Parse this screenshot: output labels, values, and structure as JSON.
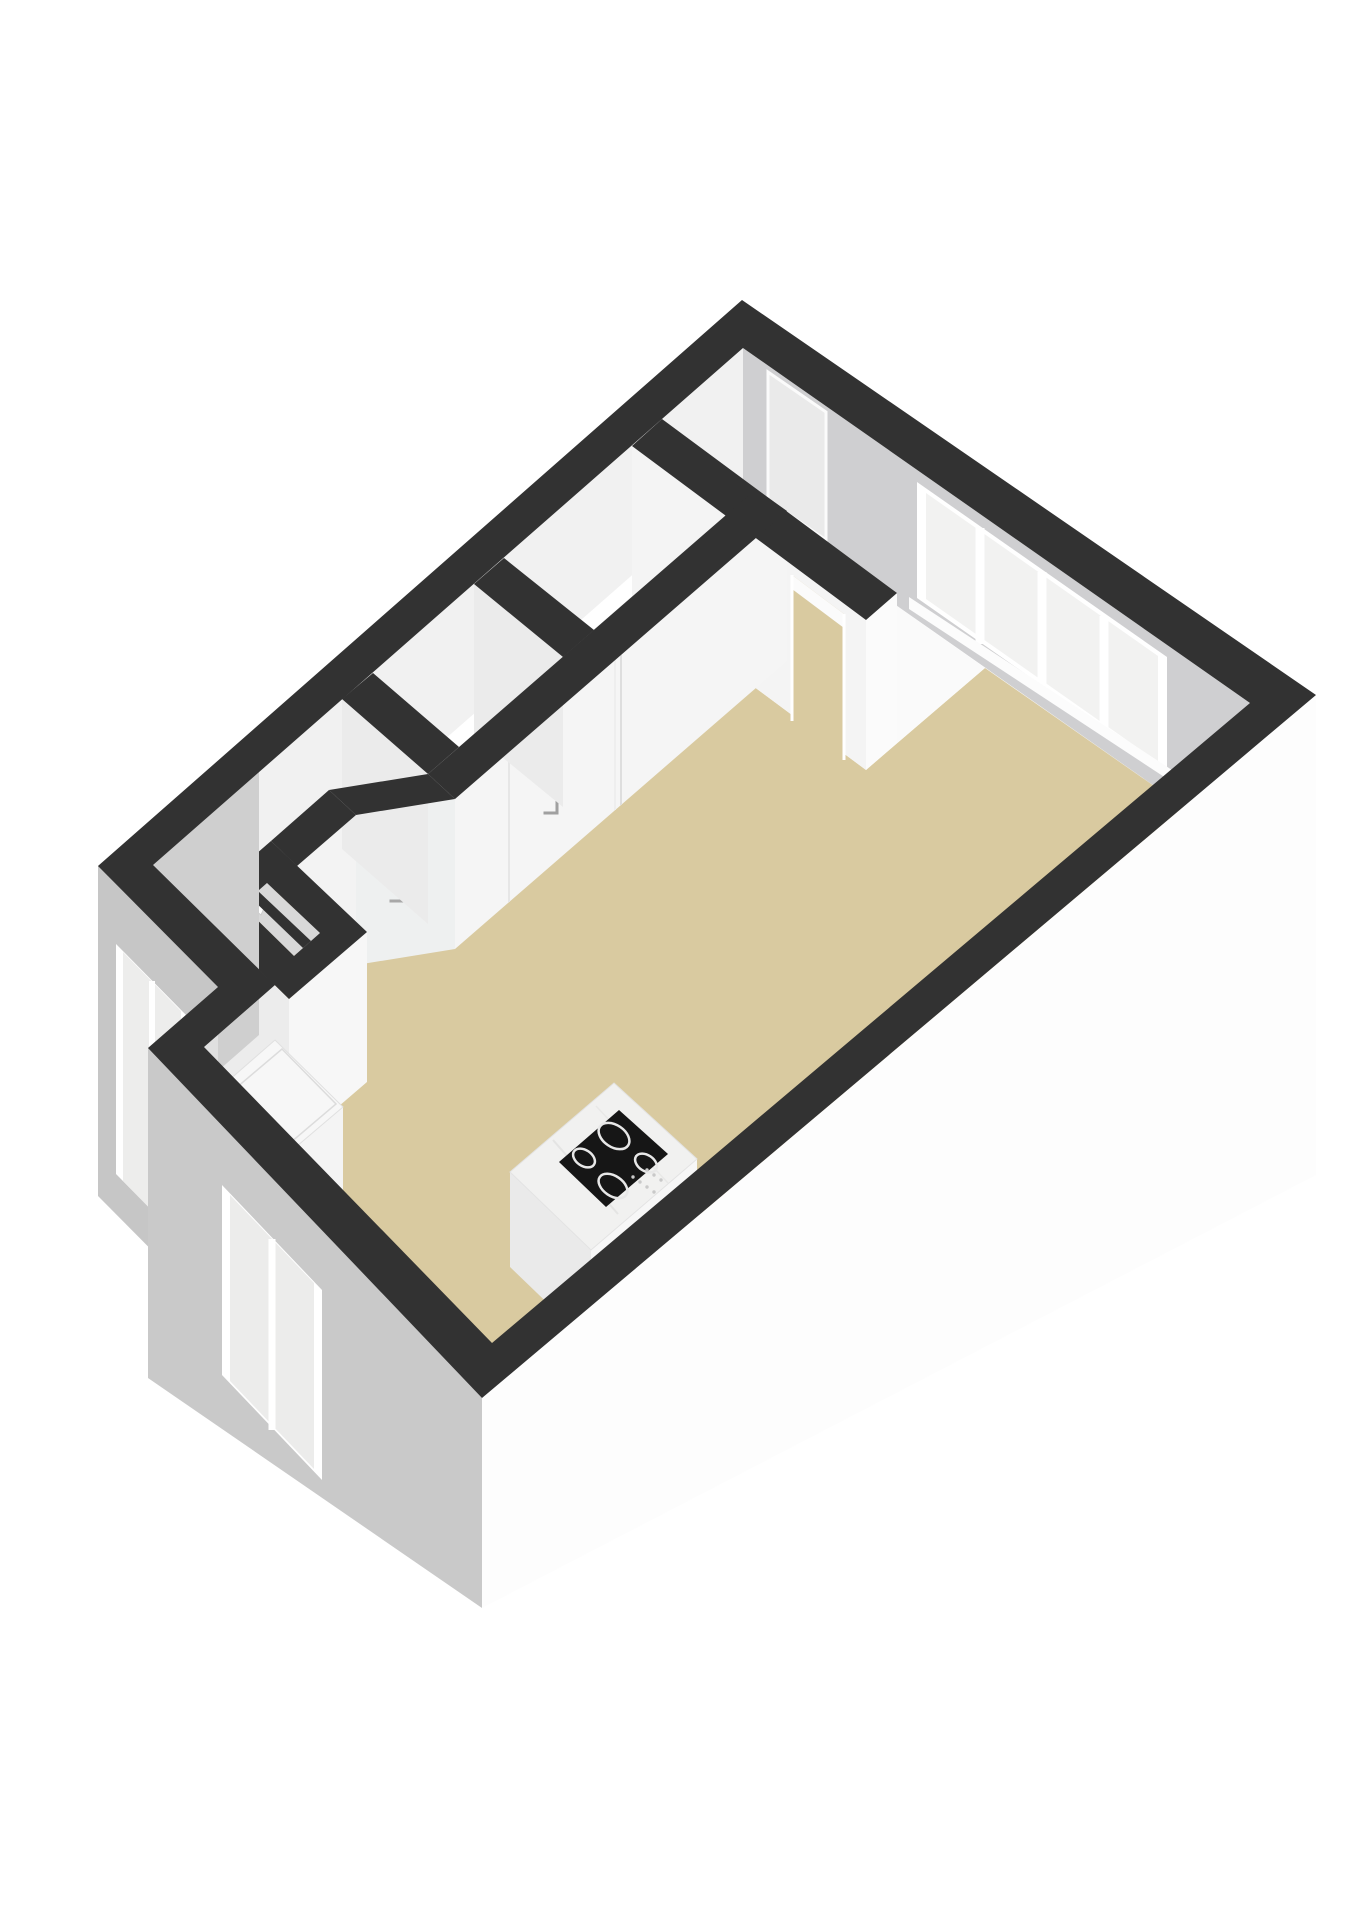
{
  "meta": {
    "view": "floorplan-3d-overview"
  },
  "colors": {
    "background": "#ffffff",
    "wall_cap_dark": "#323232",
    "floor_beige": "#d9caa0",
    "floor_white": "#fafafa",
    "wall_interior_gray": "#cfcfd1",
    "wall_interior_white": "#f1f1f1",
    "exterior_white": "#fdfdfd",
    "exterior_gray": "#c9c9c9",
    "window_frame": "#ffffff",
    "glass": "#f2f2f1",
    "marble": "#f1f1f0",
    "cooktop_black": "#161616"
  },
  "scene": {
    "width": 1358,
    "height": 1920,
    "layers": [
      {
        "name": "floors",
        "shapes": [
          {
            "kind": "poly",
            "name": "main-room-floor",
            "points": "985,668 1250,853 492,1351 204,1055 275,993 153,873 314,874 398,950 726,666 866,770",
            "fill": "#d9caa0"
          },
          {
            "kind": "poly",
            "name": "hall-floor",
            "points": "743,498 985,668 897,743 662,569",
            "fill": "#fafafa"
          },
          {
            "kind": "poly",
            "name": "bathroom-floor",
            "points": "632,596 726,666 594,780 504,708",
            "fill": "#f7f7f7"
          },
          {
            "kind": "poly",
            "name": "toilet-floor",
            "points": "474,734 563,807 459,897 373,823",
            "fill": "#f7f7f7"
          }
        ]
      },
      {
        "name": "far-walls",
        "shapes": [
          {
            "kind": "poly",
            "name": "northeast-wall-face",
            "points": "743,348 1250,703 1250,853 743,498",
            "fill": "#cfcfd1"
          },
          {
            "kind": "poly",
            "name": "entrance-door",
            "points": "768,372 826,412 826,540 768,500",
            "fill": "#eaeaea",
            "stroke": "#fbfbfb",
            "sw": 3
          },
          {
            "kind": "poly",
            "name": "main-window-frame",
            "points": "917,482 1167,657 1167,773 917,598",
            "fill": "#ffffff"
          },
          {
            "kind": "poly",
            "name": "main-window-glass",
            "points": "926,493 1158,656 1158,762 926,599",
            "fill": "#f2f2f1"
          },
          {
            "kind": "line",
            "name": "main-window-mullion-1",
            "x1": 980,
            "y1": 528,
            "x2": 980,
            "y2": 644,
            "stroke": "#ffffff",
            "sw": 9
          },
          {
            "kind": "line",
            "name": "main-window-mullion-2",
            "x1": 1042,
            "y1": 572,
            "x2": 1042,
            "y2": 688,
            "stroke": "#ffffff",
            "sw": 9
          },
          {
            "kind": "line",
            "name": "main-window-mullion-3",
            "x1": 1104,
            "y1": 616,
            "x2": 1104,
            "y2": 732,
            "stroke": "#ffffff",
            "sw": 9
          },
          {
            "kind": "poly",
            "name": "main-window-sill",
            "points": "909,597 1175,772 1175,784 909,609",
            "fill": "#fcfcfc"
          },
          {
            "kind": "poly",
            "name": "northwest-wall-face",
            "points": "743,348 153,865 153,995 743,478",
            "fill": "#f1f1f1"
          }
        ]
      },
      {
        "name": "partitions",
        "shapes": [
          {
            "kind": "poly",
            "name": "hall-partition-face",
            "points": "632,446 866,620 866,770 632,596",
            "fill": "#f4f4f4"
          },
          {
            "kind": "poly",
            "name": "doorway-opening",
            "points": "792,575 844,614 844,760 792,721",
            "fill": "#d9caa0"
          },
          {
            "kind": "poly",
            "name": "doorway-top-sliver",
            "points": "792,575 844,614 844,628 792,589",
            "fill": "#fbfbfb"
          },
          {
            "kind": "line",
            "name": "doorway-jamb-left",
            "x1": 792,
            "y1": 575,
            "x2": 792,
            "y2": 721,
            "stroke": "#ffffff",
            "sw": 3
          },
          {
            "kind": "line",
            "name": "doorway-jamb-right",
            "x1": 844,
            "y1": 614,
            "x2": 844,
            "y2": 760,
            "stroke": "#ffffff",
            "sw": 3
          },
          {
            "kind": "poly",
            "name": "hall-partition-end-face",
            "points": "897,593 866,620 866,770 897,743",
            "fill": "#fbfbfb"
          },
          {
            "kind": "poly",
            "name": "closet-wall-face",
            "points": "787,511 455,799 455,949 787,661",
            "fill": "#f5f5f5"
          },
          {
            "kind": "line",
            "name": "closet-door-seam-1",
            "x1": 621,
            "y1": 655,
            "x2": 621,
            "y2": 805,
            "stroke": "#dedede",
            "sw": 2
          },
          {
            "kind": "line",
            "name": "closet-door-seam-2",
            "x1": 615,
            "y1": 660,
            "x2": 615,
            "y2": 810,
            "stroke": "#eeeeee",
            "sw": 2
          },
          {
            "kind": "line",
            "name": "closet-door-seam-3",
            "x1": 509,
            "y1": 752,
            "x2": 509,
            "y2": 902,
            "stroke": "#e6e6e6",
            "sw": 2
          },
          {
            "kind": "polyline",
            "name": "door-handle-1",
            "points": "557,795 557,813 545,813",
            "stroke": "#a0a0a0",
            "sw": 3
          },
          {
            "kind": "poly",
            "name": "angled-wall-face",
            "points": "455,799 356,815 356,965 455,949",
            "fill": "#eef0f0"
          },
          {
            "kind": "polyline",
            "name": "door-handle-2",
            "points": "402,884 402,901 391,901",
            "stroke": "#a8a8a8",
            "sw": 3
          },
          {
            "kind": "poly",
            "name": "lower-wall-face",
            "points": "356,815 297,866 297,1016 356,965",
            "fill": "#f3f3f3"
          },
          {
            "kind": "poly",
            "name": "partition-band-1",
            "points": "474,584 563,657 563,807 474,734",
            "fill": "#ebebeb"
          },
          {
            "kind": "poly",
            "name": "partition-band-2",
            "points": "342,699 428,774 428,924 342,849",
            "fill": "#ebebeb"
          },
          {
            "kind": "poly",
            "name": "step-wall-face",
            "points": "275,985 204,1047 204,1197 275,1135",
            "fill": "#f6f6f6"
          }
        ]
      },
      {
        "name": "shaft",
        "shapes": [
          {
            "kind": "poly",
            "name": "shaft-side-southwest",
            "points": "195,907 289,999 289,1149 195,1057",
            "fill": "#ececec"
          },
          {
            "kind": "poly",
            "name": "shaft-side-southeast",
            "points": "367,932 289,999 289,1149 367,1082",
            "fill": "#f7f7f7"
          },
          {
            "kind": "poly",
            "name": "shaft-interior",
            "points": "267,883 320,933 294,956 242,905",
            "fill": "#d8d8d8"
          },
          {
            "kind": "poly",
            "name": "meter-box",
            "points": "254,894 266,904 261,915 249,905",
            "fill": "#ffffff",
            "stroke": "#cccccc",
            "sw": 1
          },
          {
            "kind": "poly",
            "name": "shaft-divider-cap",
            "points": "258,891 311,941 303,948 251,898",
            "fill": "#323232"
          },
          {
            "kind": "path",
            "name": "shaft-wall-cap",
            "d": "M271,841 L367,932 L289,999 L195,907 Z M267,883 L320,933 L294,956 L242,905 Z",
            "fill": "#323232",
            "rule": "evenodd"
          }
        ]
      },
      {
        "name": "kitchen-cabinet",
        "shapes": [
          {
            "kind": "poly",
            "name": "cabinet-side-southwest",
            "points": "204,1102 270,1169 270,1264 204,1197",
            "fill": "#e8e8e8"
          },
          {
            "kind": "poly",
            "name": "cabinet-side-southeast",
            "points": "343,1107 270,1169 270,1264 343,1202",
            "fill": "#f4f4f4"
          },
          {
            "kind": "poly",
            "name": "cabinet-countertop",
            "points": "275,1040 343,1107 270,1169 204,1102",
            "fill": "#f7f7f7",
            "stroke": "#e0e0e0",
            "sw": 1
          },
          {
            "kind": "poly",
            "name": "cabinet-countertop-inset",
            "points": "282,1049 336,1104 270,1160 216,1105",
            "fill": "none",
            "stroke": "#dcdcdc",
            "sw": 1.5
          }
        ]
      },
      {
        "name": "kitchen-island",
        "shapes": [
          {
            "kind": "poly",
            "name": "island-side-southwest",
            "points": "510,1172 591,1250 591,1345 510,1267",
            "fill": "#eaeaea"
          },
          {
            "kind": "poly",
            "name": "island-side-southeast",
            "points": "697,1159 591,1250 591,1345 697,1254",
            "fill": "#f7f7f7"
          },
          {
            "kind": "poly",
            "name": "island-marble-top",
            "points": "614,1083 697,1159 591,1250 510,1172",
            "fill": "#f1f1f0",
            "stroke": "#e3e3e3",
            "sw": 1
          },
          {
            "kind": "line",
            "name": "marble-vein-1",
            "x1": 553,
            "y1": 1140,
            "x2": 618,
            "y2": 1214,
            "stroke": "#e4e4e3",
            "sw": 2
          },
          {
            "kind": "line",
            "name": "marble-vein-2",
            "x1": 596,
            "y1": 1106,
            "x2": 668,
            "y2": 1183,
            "stroke": "#e8e8e7",
            "sw": 1.5
          },
          {
            "kind": "poly",
            "name": "cooktop",
            "points": "619,1110 668,1154 606,1207 559,1162",
            "fill": "#161616"
          },
          {
            "kind": "ellipse",
            "name": "cooktop-burner-1",
            "cx": 614,
            "cy": 1136,
            "rx": 17,
            "ry": 11,
            "rot": 34,
            "fill": "none",
            "stroke": "#e8e8e8",
            "sw": 2.5
          },
          {
            "kind": "ellipse",
            "name": "cooktop-burner-2",
            "cx": 646,
            "cy": 1163,
            "rx": 12,
            "ry": 8,
            "rot": 34,
            "fill": "none",
            "stroke": "#e8e8e8",
            "sw": 2.5
          },
          {
            "kind": "ellipse",
            "name": "cooktop-burner-3",
            "cx": 584,
            "cy": 1158,
            "rx": 12,
            "ry": 8,
            "rot": 34,
            "fill": "none",
            "stroke": "#e8e8e8",
            "sw": 2.5
          },
          {
            "kind": "ellipse",
            "name": "cooktop-burner-4",
            "cx": 613,
            "cy": 1186,
            "rx": 16,
            "ry": 10,
            "rot": 34,
            "fill": "none",
            "stroke": "#e8e8e8",
            "sw": 2.5
          },
          {
            "kind": "dots",
            "name": "cooktop-controls",
            "r": 1.7,
            "fill": "#c9c9c9",
            "centers": [
              [
                633,
                1177
              ],
              [
                640,
                1182
              ],
              [
                647,
                1187
              ],
              [
                654,
                1192
              ],
              [
                647,
                1170
              ],
              [
                654,
                1175
              ],
              [
                661,
                1180
              ]
            ]
          }
        ]
      },
      {
        "name": "exterior",
        "shapes": [
          {
            "kind": "poly",
            "name": "northwest-exterior-sliver",
            "points": "259,725 98,866 98,1176 259,1035",
            "fill": "#cfcfcf"
          },
          {
            "kind": "poly",
            "name": "northwest-exterior-window-hint",
            "points": "135,835 108,858 108,1088 135,1065",
            "fill": "#efefef"
          },
          {
            "kind": "poly",
            "name": "notch-wall-exterior",
            "points": "98,866 218,987 218,1317 98,1196",
            "fill": "#c6c6c6"
          },
          {
            "kind": "poly",
            "name": "notch-window-frame",
            "points": "116,944 188,1017 188,1247 116,1174",
            "fill": "#ffffff"
          },
          {
            "kind": "poly",
            "name": "notch-window-glass",
            "points": "123,952 181,1011 181,1240 123,1181",
            "fill": "#ededec"
          },
          {
            "kind": "line",
            "name": "notch-window-mullion",
            "x1": 152,
            "y1": 981,
            "x2": 152,
            "y2": 1212,
            "stroke": "#ffffff",
            "sw": 6
          },
          {
            "kind": "poly",
            "name": "step-wall-exterior",
            "points": "218,987 148,1048 148,1378 218,1317",
            "fill": "#e0e0e0"
          },
          {
            "kind": "poly",
            "name": "southwest-wall-exterior",
            "points": "482,1398 148,1048 148,1378 482,1608",
            "fill": "#c9c9c9"
          },
          {
            "kind": "poly",
            "name": "southwest-window-frame",
            "points": "222,1185 322,1290 322,1480 222,1375",
            "fill": "#ffffff"
          },
          {
            "kind": "poly",
            "name": "southwest-window-glass",
            "points": "230,1195 314,1283 314,1469 230,1381",
            "fill": "#ececeb"
          },
          {
            "kind": "line",
            "name": "southwest-window-mullion",
            "x1": 272,
            "y1": 1239,
            "x2": 272,
            "y2": 1430,
            "stroke": "#ffffff",
            "sw": 7
          },
          {
            "kind": "poly",
            "name": "southeast-wall-exterior",
            "points": "1316,695 482,1398 482,1608 1316,1175",
            "fill": "#fdfdfd"
          }
        ]
      },
      {
        "name": "wall-caps",
        "shapes": [
          {
            "kind": "path",
            "name": "exterior-wall-caps",
            "d": "M742,300 L1316,695 L482,1398 L148,1048 L218,987 L98,866 Z M743,348 L1250,703 L492,1343 L204,1047 L275,985 L153,865 Z",
            "fill": "#323232",
            "rule": "evenodd"
          },
          {
            "kind": "poly",
            "name": "hall-partition-cap",
            "points": "662,419 897,593 866,620 632,446",
            "fill": "#323232"
          },
          {
            "kind": "poly",
            "name": "closet-wall-cap",
            "points": "756,489 787,511 455,799 428,774",
            "fill": "#323232"
          },
          {
            "kind": "poly",
            "name": "angled-wall-cap",
            "points": "428,774 455,799 356,815 329,790",
            "fill": "#323232"
          },
          {
            "kind": "poly",
            "name": "lower-wall-cap",
            "points": "329,790 356,815 297,866 271,841",
            "fill": "#323232"
          },
          {
            "kind": "poly",
            "name": "bathroom-partition-cap",
            "points": "504,558 594,630 563,657 474,584",
            "fill": "#323232"
          },
          {
            "kind": "poly",
            "name": "toilet-partition-cap",
            "points": "373,673 459,747 428,774 342,699",
            "fill": "#323232"
          }
        ]
      }
    ]
  }
}
